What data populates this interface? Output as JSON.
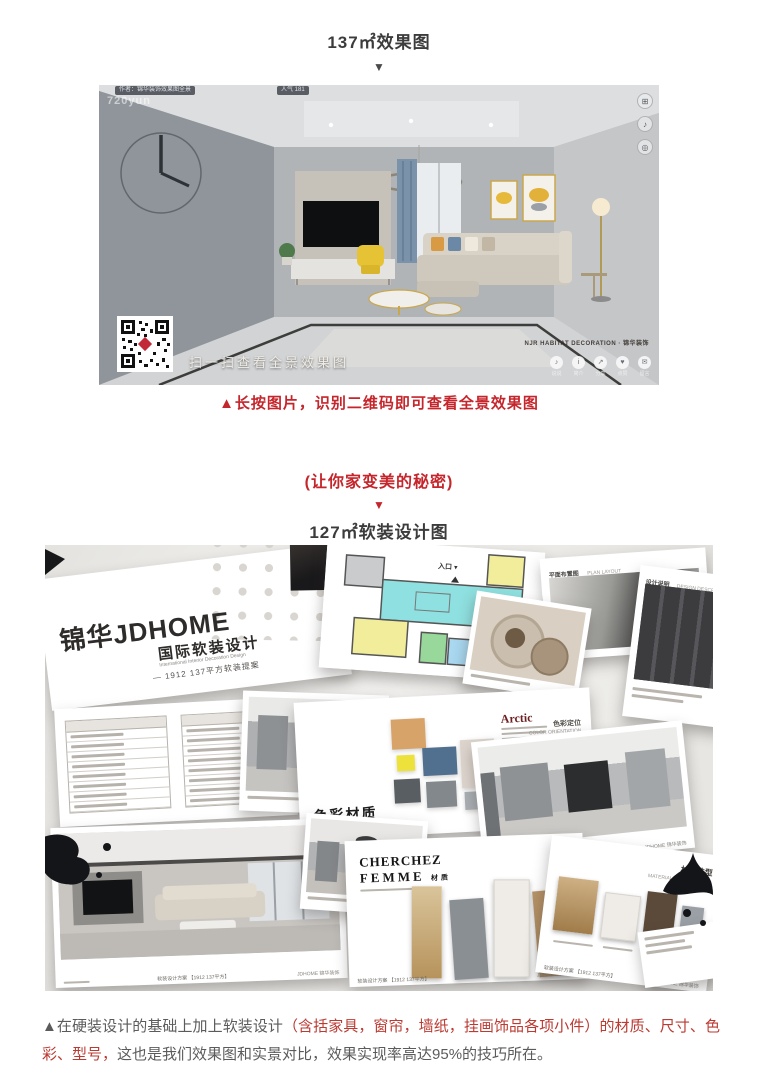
{
  "article": {
    "section_effect": {
      "title": "137㎡效果图",
      "arrow": "▼",
      "caption": "▲长按图片，识别二维码即可查看全景效果图"
    },
    "section_soft": {
      "secret": "(让你家变美的秘密)",
      "arrow": "▼",
      "title": "127㎡软装设计图"
    },
    "footer_note": {
      "gray_lead": "▲在硬装设计的基础上加上软装设计",
      "red_mid": "（含括家具，窗帘，墙纸，挂画饰品各项小件）的材质、尺寸、色彩、型号，",
      "gray_tail": "这也是我们效果图和实景对比，效果实现率高达95%的技巧所在。"
    }
  },
  "panorama": {
    "author_label": "作者：锦华装饰效果图全景",
    "views_label": "人气 181",
    "watermark": "720yun",
    "qr_caption": "扫一扫查看全景效果图",
    "brand_watermark": "NJR HABITAT DECORATION · 锦华装饰",
    "corner_buttons": [
      {
        "name": "fullscreen",
        "glyph": "⊞"
      },
      {
        "name": "audio",
        "glyph": "♪"
      },
      {
        "name": "vr",
        "glyph": "◎"
      }
    ],
    "toolbar": [
      {
        "label": "说说",
        "glyph": "♪"
      },
      {
        "label": "简介",
        "glyph": "i"
      },
      {
        "label": "分享",
        "glyph": "↗"
      },
      {
        "label": "点赞",
        "glyph": "♥"
      },
      {
        "label": "留言",
        "glyph": "✉"
      }
    ]
  },
  "collage": {
    "cover_card": {
      "brand": "锦华JDHOME",
      "title": "国际软装设计",
      "title_en": "International Interior Decoration Design",
      "tagline": "— 1912  137平方软装提案"
    },
    "floorplan_card": {
      "entrance": "入口 ▾"
    },
    "layout_card": {
      "title": "平面布置图",
      "title_en": "PLAN LAYOUT"
    },
    "note_card": {
      "title": "设计说明",
      "title_en": "DESIGN DESCRIPTION"
    },
    "palette_card": {
      "title": "Arctic",
      "side_label": "色彩定位",
      "side_label_en": "COLOR ORIENTATION",
      "corner_label": "色彩材质",
      "swatches": [
        "#d8a368",
        "#ece23b",
        "#51708f",
        "#a9aeb2",
        "#ddd5cd",
        "#595e62",
        "#83888c"
      ]
    },
    "cherchez_card": {
      "title_1": "CHERCHEZ",
      "title_2": "FEMME",
      "suffix": "材质"
    },
    "material_card": {
      "title": "材质选型",
      "title_en": "MATERIAL SPECIFICATION"
    },
    "scheme_footer": {
      "center": "软装设计方案 【1912 137平方】",
      "en": "SOFT ADORNMENT DESIGN",
      "brand": "JDHOME 锦华装饰"
    }
  }
}
